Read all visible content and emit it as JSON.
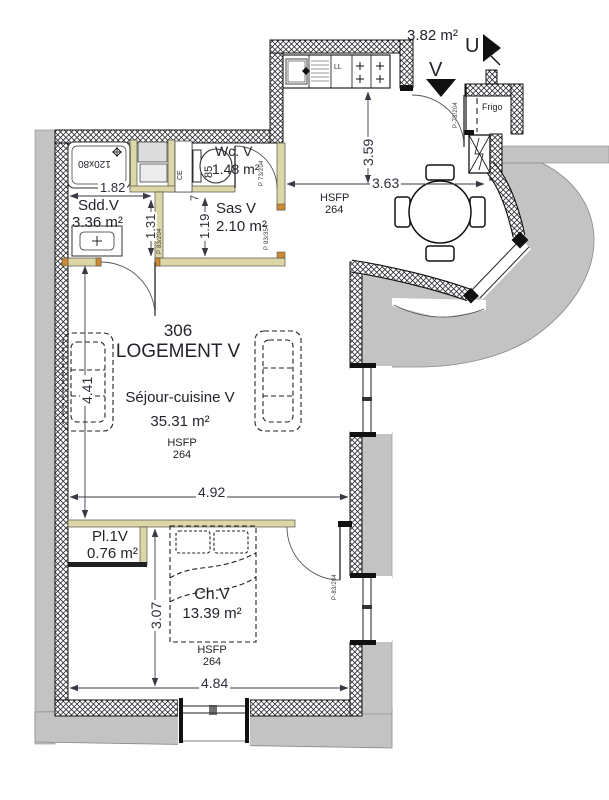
{
  "unit": {
    "number": "306",
    "name": "LOGEMENT V"
  },
  "rooms": {
    "sdd": {
      "name": "Sdd.V",
      "area": "3.36 m²"
    },
    "wc": {
      "name": "Wc. V",
      "area": "1.48 m²"
    },
    "sas": {
      "name": "Sas V",
      "area": "2.10 m²"
    },
    "sejour": {
      "name": "Séjour-cuisine V",
      "area": "35.31 m²"
    },
    "placard": {
      "name": "Pl.1V",
      "area": "0.76 m²"
    },
    "chambre": {
      "name": "Ch.V",
      "area": "13.39 m²"
    },
    "entry": {
      "area": "3.82 m²"
    }
  },
  "dims": {
    "d182": "1.82",
    "d131": "1.31",
    "d119": "1.19",
    "d7": "7",
    "d359": "3.59",
    "d363": "3.63",
    "d441": "4.41",
    "d492": "4.92",
    "d307": "3.07",
    "d484": "4.84"
  },
  "labels": {
    "frigo": "Frigo",
    "ll": "LL",
    "ce": "CE",
    "shower_size": "120x80",
    "wc_width": "85",
    "stair_up": "U",
    "stair_down": "V",
    "hsfp": "HSFP",
    "hsfp_value": "264"
  },
  "door_tags": {
    "sdd": "P 83/204",
    "wc": "P 73/204",
    "sas": "P 83/354",
    "entry": "P-73/204",
    "chambre": "P-83/204"
  },
  "colors": {
    "wall_gray": "#c3c3c3",
    "partition_beige": "#ddd6a6",
    "jamb_tan": "#cc8a33",
    "ink": "#23232b"
  }
}
